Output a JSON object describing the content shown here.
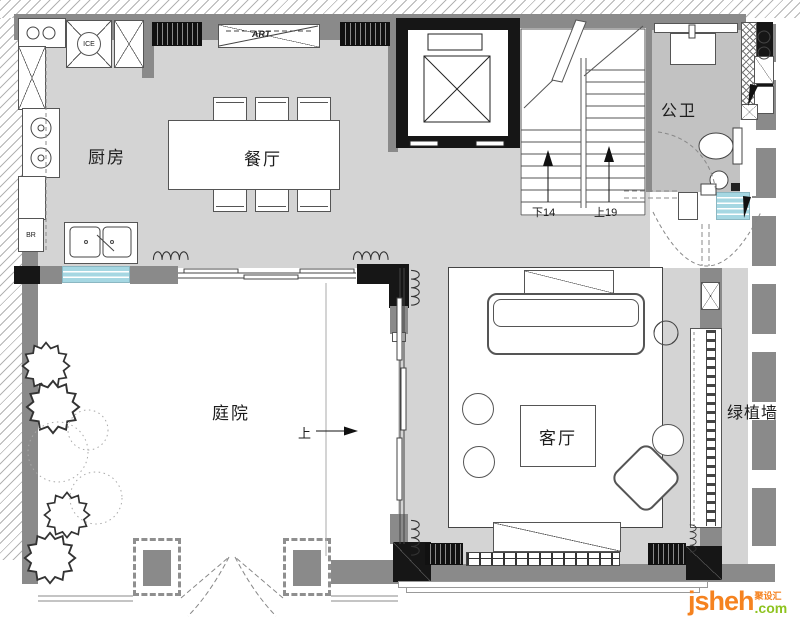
{
  "colors": {
    "wall": "#8a8a8a",
    "floor": "#d4d4d4",
    "bath_floor": "#c2c2c2",
    "window_blue": "#a5d7e2",
    "black": "#161616",
    "line": "#555555",
    "logo_orange": "#f5821f",
    "logo_green": "#8ec31f"
  },
  "plan": {
    "rooms": {
      "kitchen": "厨房",
      "dining": "餐厅",
      "bath": "公卫",
      "courtyard": "庭院",
      "living": "客厅",
      "plant_wall": "绿植墙"
    },
    "stairs": {
      "down": "下14",
      "up": "上19"
    },
    "annotations": {
      "art": "ART",
      "ice": "ICE",
      "br": "BR",
      "up": "上"
    },
    "logo": {
      "name": "jsheh",
      "tld": ".com",
      "cn": "聚设汇"
    }
  }
}
